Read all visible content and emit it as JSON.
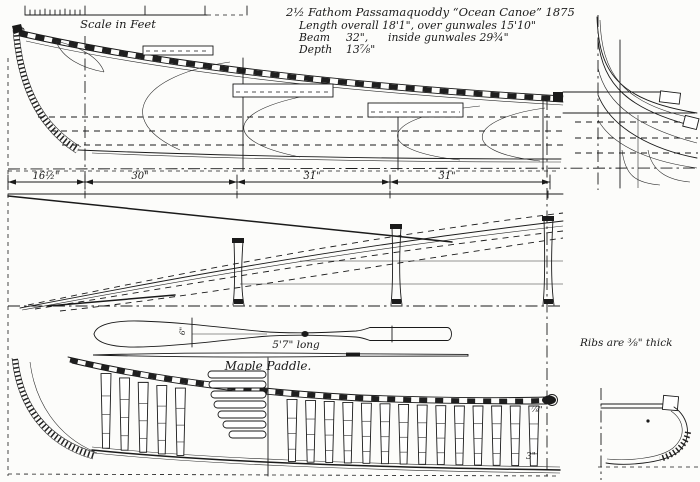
{
  "scale": {
    "label": "Scale in Feet"
  },
  "title": {
    "line1": "2½  Fathom Passamaquoddy “Ocean Canoe”  1875",
    "length_line": "Length overall 18'1\", over gunwales 15'10\"",
    "beam_label": "Beam",
    "beam_value": "32\",",
    "beam_note": "inside gunwales 29¾\"",
    "depth_label": "Depth",
    "depth_value": "13⅞\""
  },
  "dims": {
    "d1": "16½\"",
    "d2": "30\"",
    "d3": "31\"",
    "d4": "31\""
  },
  "paddle": {
    "length_label": "5'7\" long",
    "name_label": "Maple Paddle.",
    "width_label": "6\""
  },
  "notes": {
    "ribs": "Ribs are ⅜\" thick"
  },
  "interior_labels": {
    "rib_top": "⅞\"",
    "rib_bottom": "3\""
  }
}
